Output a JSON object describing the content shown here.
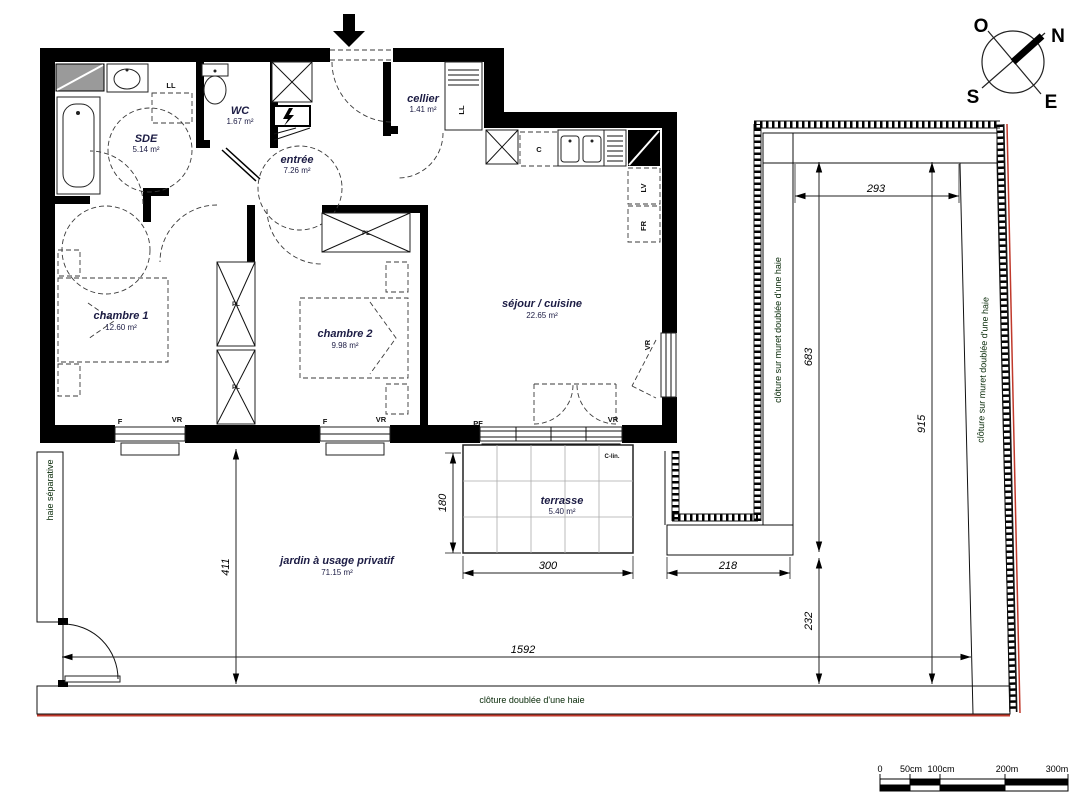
{
  "compass": {
    "n": "N",
    "e": "E",
    "s": "S",
    "o": "O"
  },
  "rooms": {
    "sde": {
      "name": "SDE",
      "area": "5.14 m²"
    },
    "wc": {
      "name": "WC",
      "area": "1.67 m²"
    },
    "cellier": {
      "name": "cellier",
      "area": "1.41 m²"
    },
    "entree": {
      "name": "entrée",
      "area": "7.26 m²"
    },
    "chambre1": {
      "name": "chambre 1",
      "area": "12.60 m²"
    },
    "chambre2": {
      "name": "chambre 2",
      "area": "9.98 m²"
    },
    "sejour": {
      "name": "séjour / cuisine",
      "area": "22.65 m²"
    },
    "terrasse": {
      "name": "terrasse",
      "area": "5.40 m²"
    },
    "jardin": {
      "name": "jardin à usage privatif",
      "area": "71.15 m²"
    }
  },
  "appliances": {
    "washing_machine": "LL",
    "hob_counter": "C",
    "dishwasher": "LV",
    "fridge": "FR",
    "closet": "PL"
  },
  "openings": {
    "window": "F",
    "shutter": "VR",
    "french_window": "PF",
    "lintel_box": "C-lin."
  },
  "hedges": {
    "left_label": "haie séparative",
    "bottom_label": "clôture doublée d'une haie",
    "middle_label": "clôture sur muret doublée d'une haie",
    "right_label": "clôture sur muret doublée d'une haie"
  },
  "dimensions": {
    "garden_width": "1592",
    "garden_height": "411",
    "terrace_width": "300",
    "terrace_height": "180",
    "path_width": "218",
    "inner_width": "293",
    "inner_height": "683",
    "lower_height": "232",
    "right_height": "915"
  },
  "scale_bar": {
    "labels": [
      "0",
      "50cm",
      "100cm",
      "200m",
      "300m"
    ]
  },
  "colors": {
    "hedge_green": "#2da32d",
    "boundary_red": "#c0392b"
  }
}
